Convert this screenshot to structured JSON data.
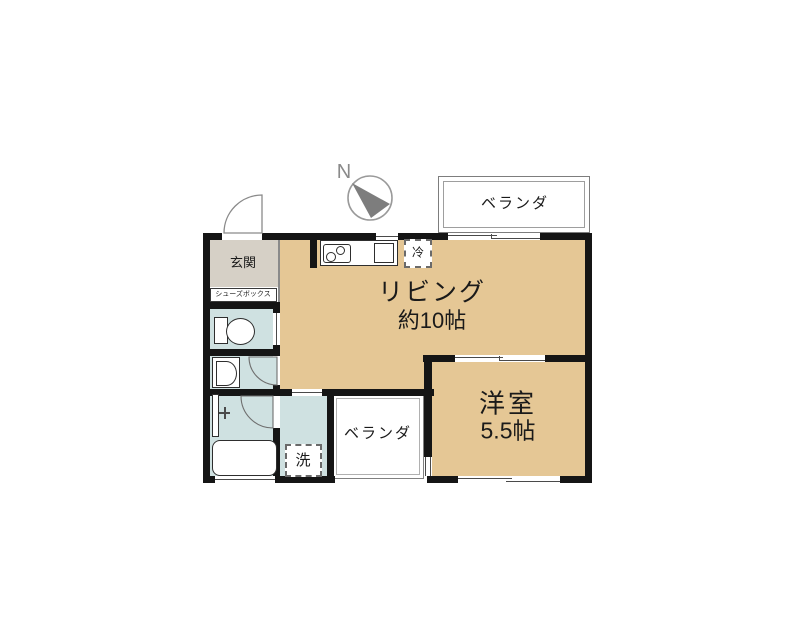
{
  "compass": {
    "label": "N"
  },
  "rooms": {
    "living": {
      "name": "リビング",
      "size": "約10帖"
    },
    "western_room": {
      "name": "洋室",
      "size": "5.5帖"
    },
    "balcony_top": {
      "label": "ベランダ"
    },
    "balcony_bottom": {
      "label": "ベランダ"
    },
    "entrance": {
      "label": "玄関"
    },
    "shoe_box": {
      "label": "シューズボックス"
    },
    "washer": {
      "label": "洗"
    },
    "refrigerator": {
      "label": "冷"
    }
  },
  "colors": {
    "room_tan": "#e5c795",
    "wet_area_blue": "#cfe1e1",
    "entrance_gray": "#d6d0c6",
    "wall_black": "#151515",
    "balcony_outline_gray": "#808080"
  }
}
